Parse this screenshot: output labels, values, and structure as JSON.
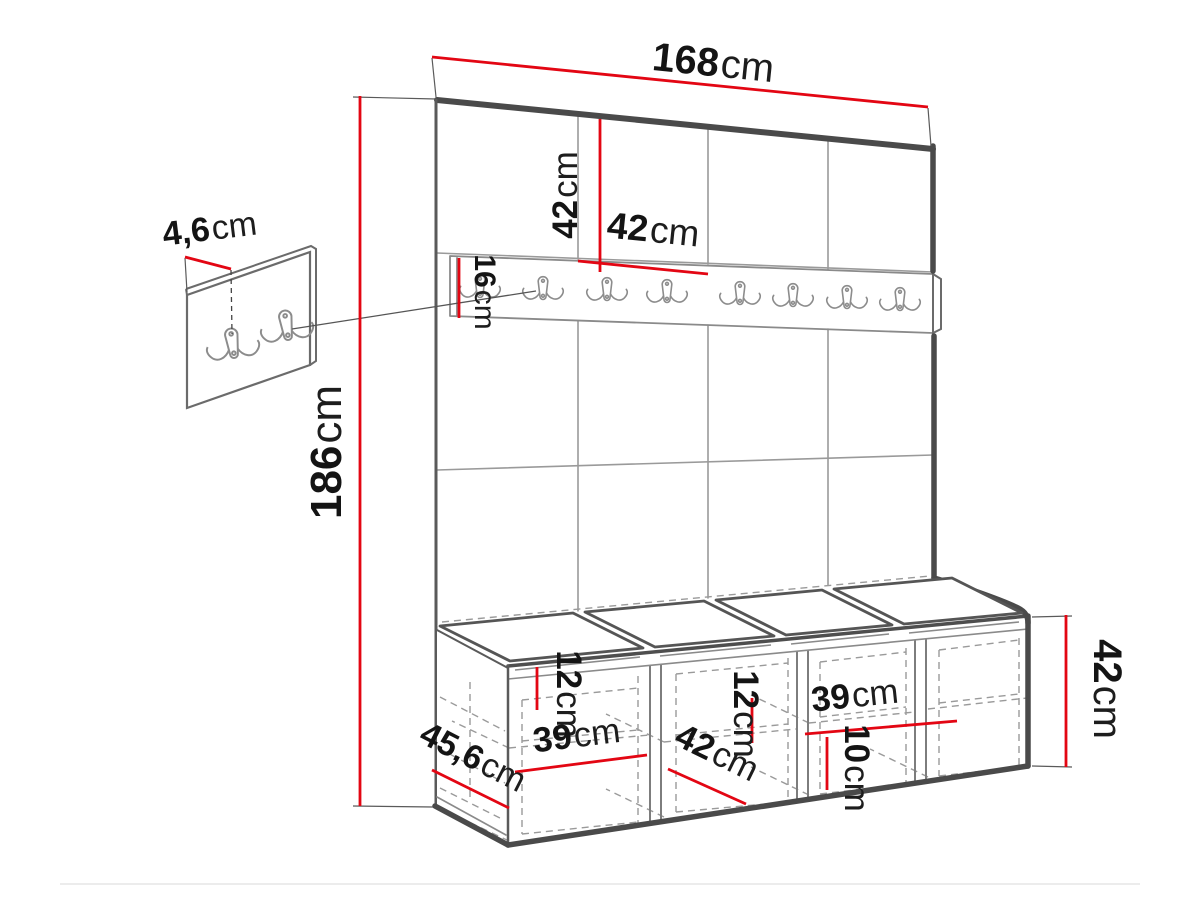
{
  "diagram": {
    "colors": {
      "dimension_red": "#e30613",
      "outline_dark": "#4a4a4a",
      "outline_mid": "#6b6b6b",
      "line_light": "#9a9a9a"
    },
    "wall_unit": {
      "width_label": {
        "value": "168",
        "unit": "cm"
      },
      "height_label": {
        "value": "186",
        "unit": "cm"
      },
      "panel_height_label": {
        "value": "42",
        "unit": "cm"
      },
      "panel_width_label": {
        "value": "42",
        "unit": "cm"
      },
      "rail_height_label": {
        "value": "16",
        "unit": "cm"
      },
      "rail_hook_count": 8,
      "panel_columns": 4
    },
    "side_panel": {
      "thickness_label": {
        "value": "4,6",
        "unit": "cm"
      },
      "hook_count": 2
    },
    "bench": {
      "height_label": {
        "value": "42",
        "unit": "cm"
      },
      "depth_label": {
        "value": "45,6",
        "unit": "cm"
      },
      "inner_left_height_label": {
        "value": "12",
        "unit": "cm"
      },
      "inner_left_width_label": {
        "value": "39",
        "unit": "cm"
      },
      "inner_middle_height_label": {
        "value": "12",
        "unit": "cm"
      },
      "inner_middle_depth_label": {
        "value": "42",
        "unit": "cm"
      },
      "inner_right_width_label": {
        "value": "39",
        "unit": "cm"
      },
      "inner_right_height_label": {
        "value": "10",
        "unit": "cm"
      },
      "compartment_count": 4,
      "cushion_count": 4
    }
  }
}
